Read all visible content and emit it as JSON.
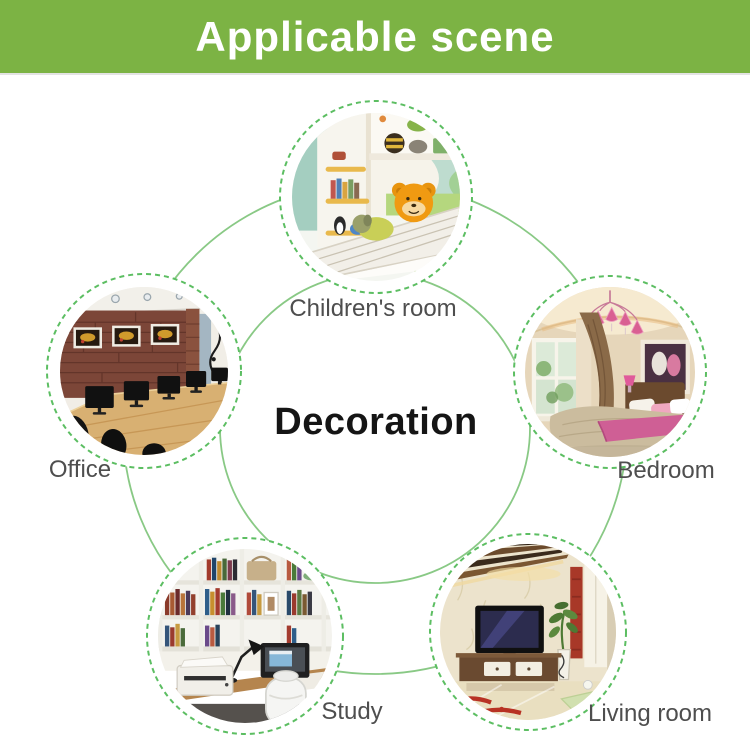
{
  "banner": {
    "title": "Applicable scene"
  },
  "center": {
    "label": "Decoration"
  },
  "scenes": [
    {
      "key": "children-room",
      "label": "Children's room"
    },
    {
      "key": "office",
      "label": "Office"
    },
    {
      "key": "bedroom",
      "label": "Bedroom"
    },
    {
      "key": "study",
      "label": "Study"
    },
    {
      "key": "living-room",
      "label": "Living room"
    }
  ],
  "colors": {
    "banner_green": "#7cb344",
    "connector_ring_green": "#89c985",
    "dashed_ring_green": "#5cbe62",
    "label_gray": "#4e4e4e",
    "center_text_black": "#151515"
  }
}
